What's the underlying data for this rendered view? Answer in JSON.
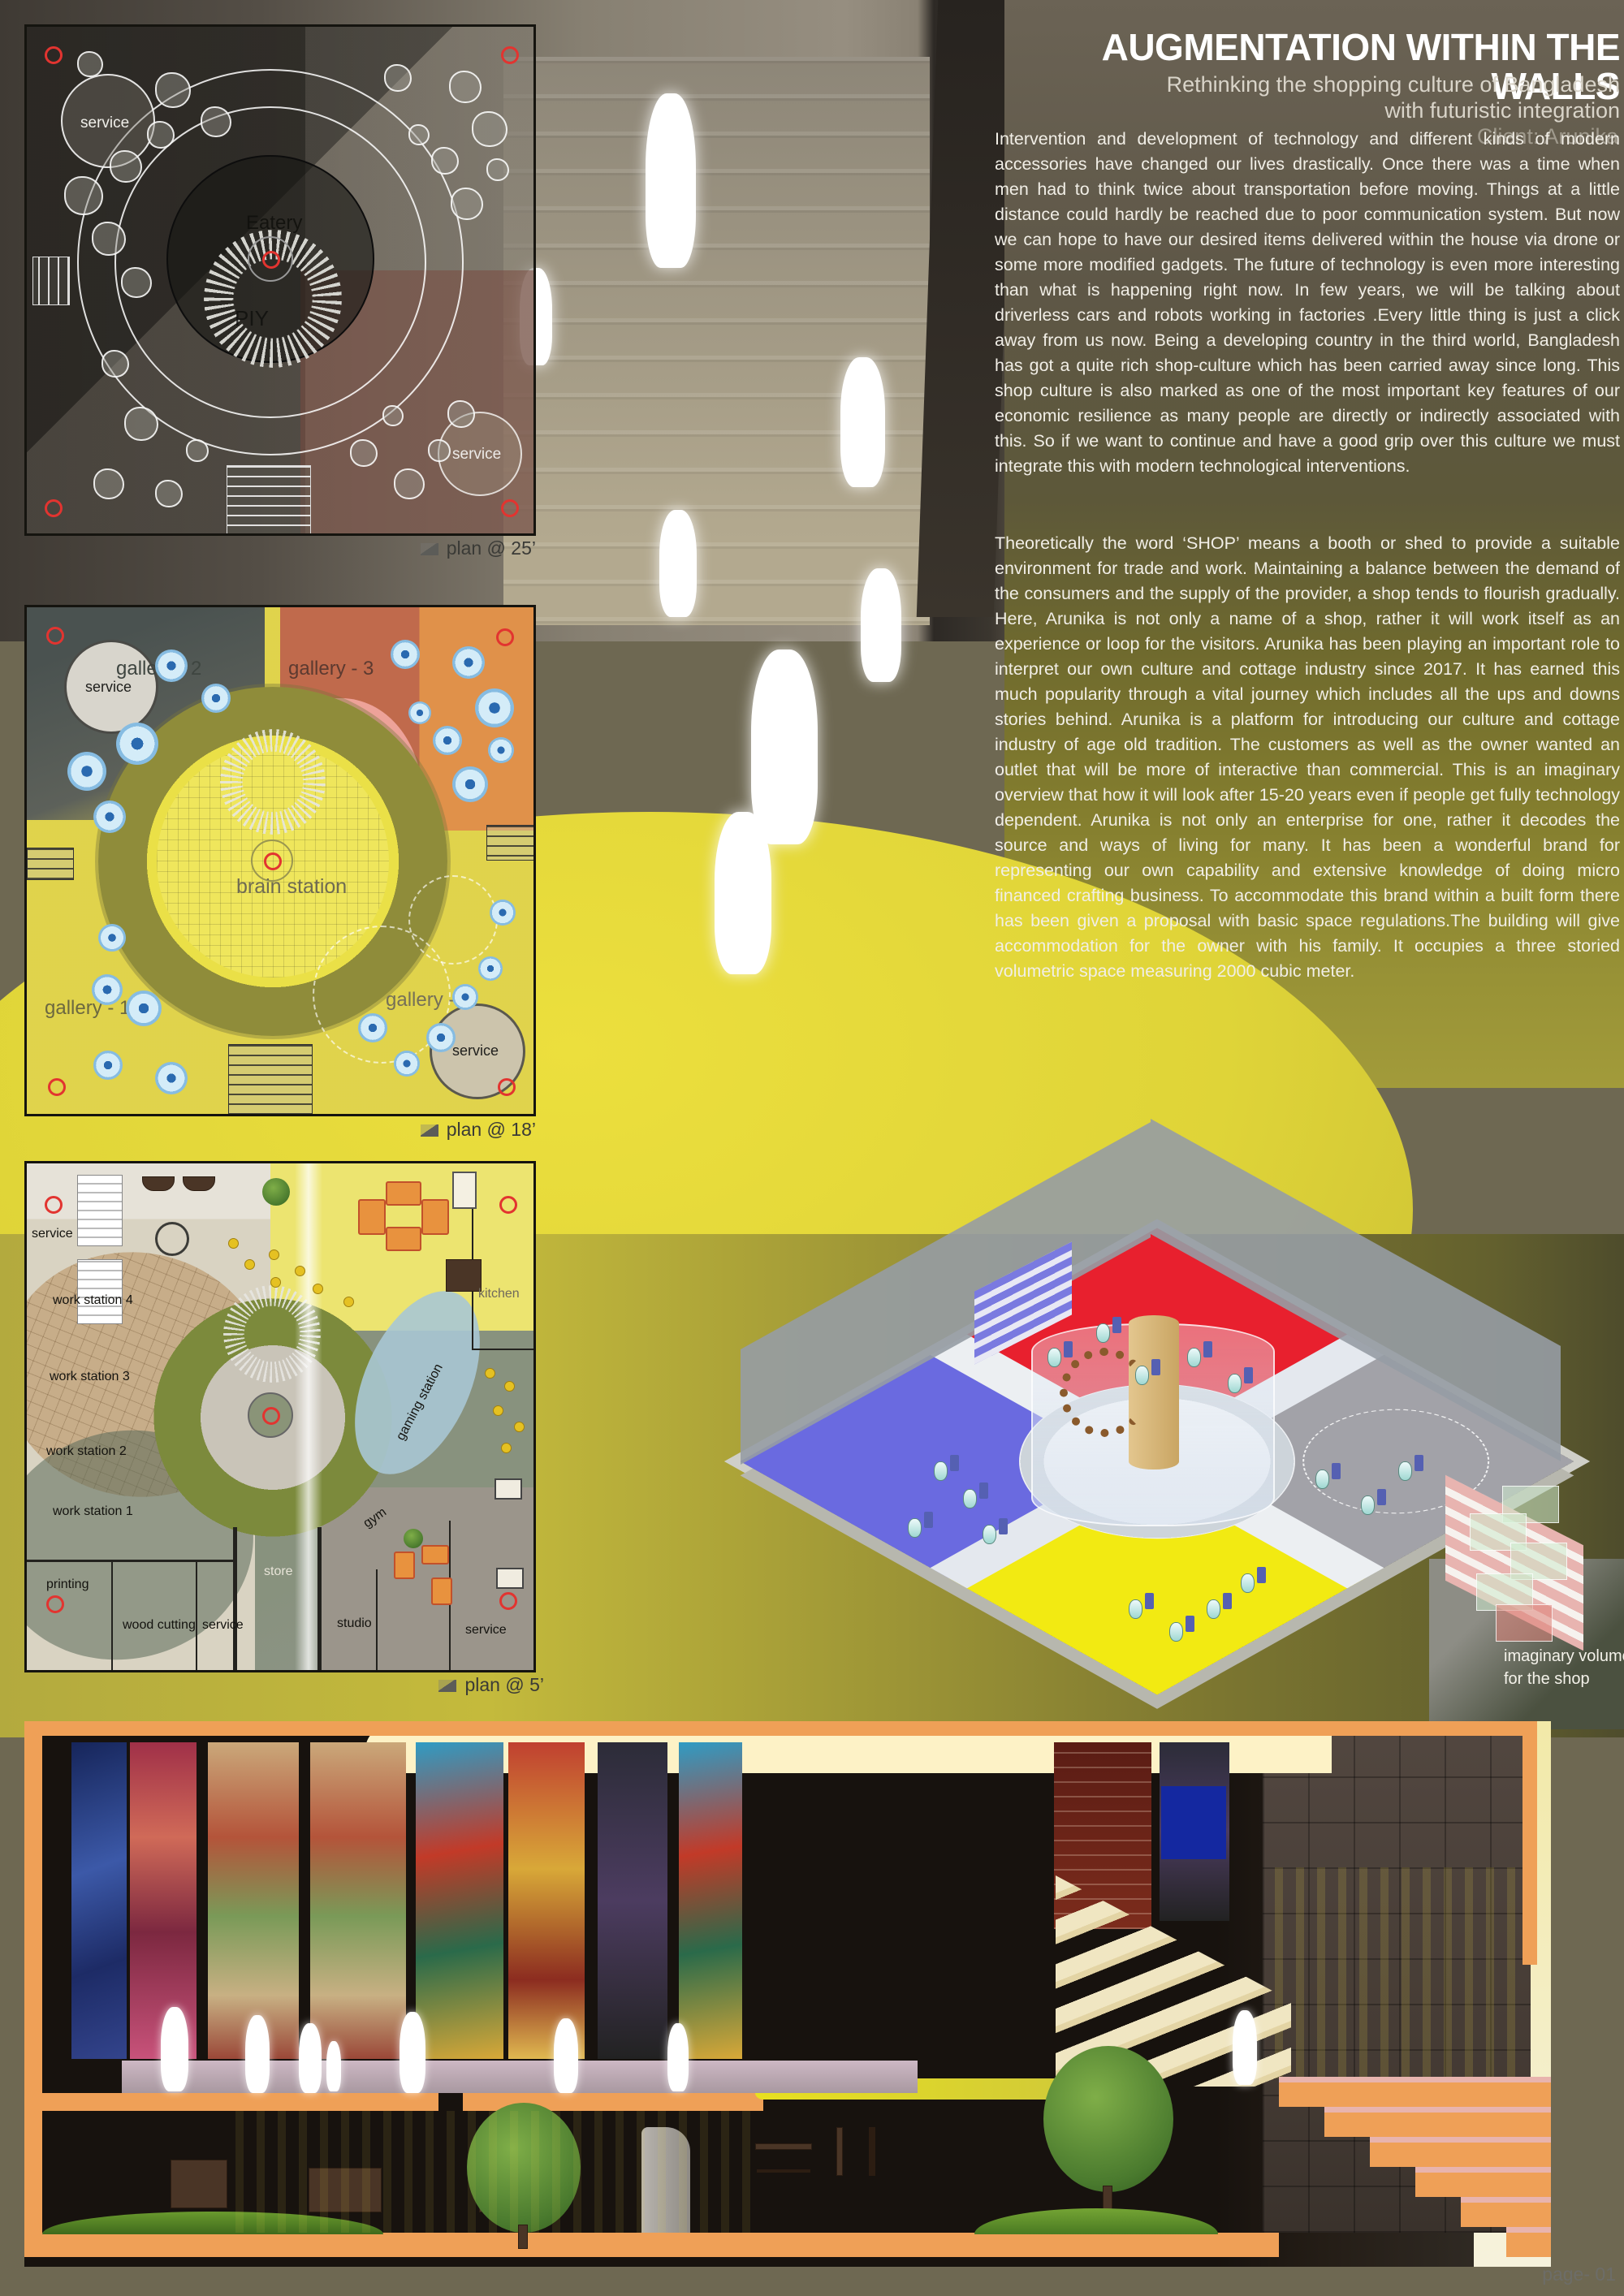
{
  "board": {
    "title": "AUGMENTATION WITHIN THE WALLS",
    "subtitle_line1": "Rethinking the shopping culture of Bangladesh",
    "subtitle_line2": "with futuristic integration",
    "client": "Client: Arunika",
    "paragraph1": "Intervention and development of technology and different kinds of modern accessories have changed our lives drastically. Once there was a time when men had to think twice about transportation before moving. Things at a little distance could hardly be reached due to poor communication system. But now we can hope to have our desired items delivered within the house via drone or some more modified gadgets. The future of technology is even more interesting than what is happening right now. In few years, we will be talking about driverless cars and robots working in factories .Every little thing is just a click away from us now. Being a developing country in the third world, Bangladesh has got a quite rich shop-culture which has been carried away since long. This shop culture is also marked as one of the most important key features of our economic resilience as many people are directly or indirectly associated with this. So if we want to continue and have a good grip over this culture we must integrate this with modern technological interventions.",
    "paragraph2": "Theoretically the word ‘SHOP’ means a booth or shed to provide a suitable environment for trade and work. Maintaining a balance between the demand of the consumers and the supply of the provider, a shop tends to flourish gradually. Here, Arunika is not only a name of a shop, rather it will work itself as an experience or loop for the visitors. Arunika has been playing an important role to interpret our own culture and cottage industry since 2017. It has earned this much popularity through a vital journey which includes all the ups and downs stories behind. Arunika is a platform for introducing our culture and cottage industry of age old tradition. The customers as well as the owner wanted an outlet that will be more of interactive than commercial. This is an imaginary overview that how it will look after 15-20 years even if people get fully technology dependent. Arunika is not only an enterprise for one, rather it decodes the source and ways of living for many. It has been a wonderful brand for representing our own capability and extensive knowledge of doing micro financed crafting business. To accommodate this brand within a built form there has been given a proposal with basic space regulations.The building will give accommodation for the owner with his family. It occupies a three storied volumetric space measuring 2000 cubic meter.",
    "page_label": "page- 01"
  },
  "plans": [
    {
      "caption": "plan @ 25’",
      "labels": {
        "service_top": "service",
        "service_bottom": "service",
        "eatery": "Eatery",
        "piy": "PIY"
      }
    },
    {
      "caption": "plan @ 18’",
      "labels": {
        "service_top": "service",
        "service_bottom": "service",
        "gallery1": "gallery - 1",
        "gallery2": "gallery - 2",
        "gallery3": "gallery - 3",
        "gallery4": "gallery - 4",
        "brain_station": "brain station"
      }
    },
    {
      "caption": "plan @ 5’",
      "labels": {
        "service_top": "service",
        "ws4": "work station 4",
        "ws3": "work station 3",
        "ws2": "work station 2",
        "ws1": "work station 1",
        "printing": "printing",
        "wood_cutting": "wood cutting",
        "service_mid": "service",
        "store": "store",
        "studio": "studio",
        "gym": "gym",
        "gaming_station": "gaming station",
        "kitchen": "kitchen",
        "service_bottom": "service"
      }
    }
  ],
  "axon": {
    "volume_label_line1": "imaginary volume",
    "volume_label_line2": "for the shop"
  },
  "colors": {
    "accent_orange": "#efa057",
    "floor_red": "#e8202e",
    "floor_blue": "#6a6ae0",
    "floor_yellow": "#f2ea12",
    "floor_gray": "#a2a2a8",
    "highlight_yellow": "#e6da35"
  }
}
